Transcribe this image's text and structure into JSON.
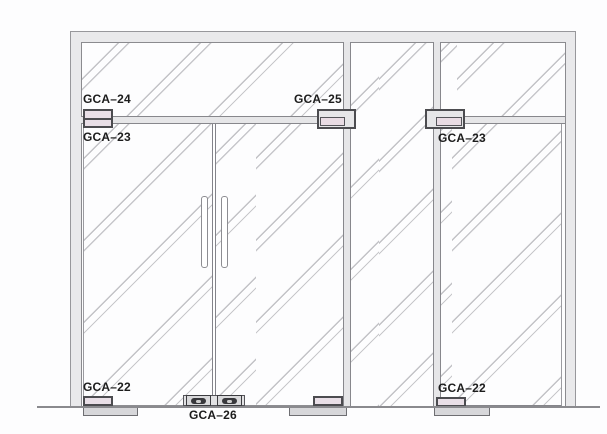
{
  "diagram": {
    "type": "elevation-drawing",
    "subject": "Glass door wall assembly with GCA patch fittings",
    "labels": {
      "gca24": "GCA–24",
      "gca23_left": "GCA–23",
      "gca25": "GCA–25",
      "gca23_right": "GCA–23",
      "gca22_left": "GCA–22",
      "gca22_right": "GCA–22",
      "gca26": "GCA–26"
    },
    "components": {
      "top_left_fitting": "overpanel transom patch with top pivot (GCA-24 / GCA-23)",
      "center_fitting": "transom rail to mullion connector (GCA-25)",
      "right_fitting": "transom patch with top pivot (GCA-23)",
      "bottom_fittings": "bottom door patches with floor plates (GCA-22)",
      "center_locks": "double-door corner floor locks (GCA-26)"
    },
    "colors": {
      "frame_fill": "#e9e9eb",
      "frame_border": "#97979b",
      "rail_fill": "#e6e6e8",
      "rail_border": "#87878c",
      "glass_hatch": "#c2c2c6",
      "fitting_pink": "#e9dfe7",
      "fitting_gray": "#e6e6e8",
      "fitting_border": "#4c4c50",
      "plate_fill": "#d7d7da",
      "lock_dark": "#38383c",
      "floor_line": "#8a8a8e",
      "label_text": "#1c1c1c"
    }
  }
}
